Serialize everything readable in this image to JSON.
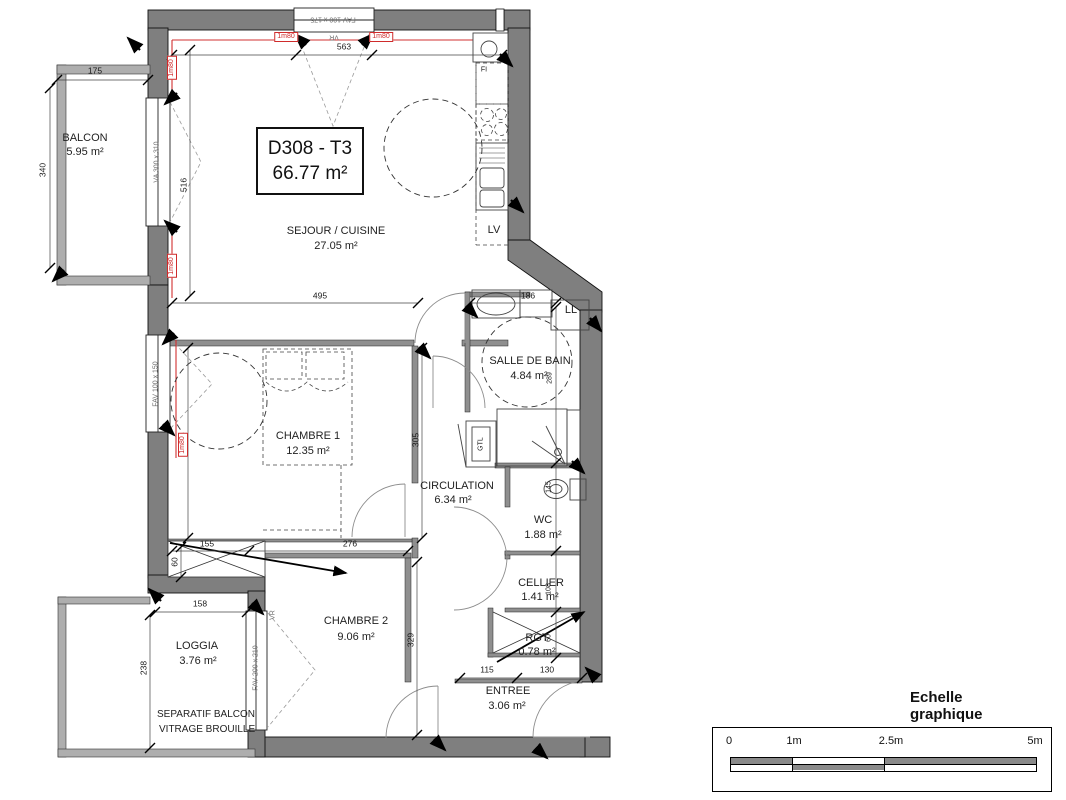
{
  "plan": {
    "unit": {
      "title": "D308 - T3",
      "area": "66.77 m²"
    },
    "rooms": [
      {
        "name": "BALCON",
        "area": "5.95 m²"
      },
      {
        "name": "SEJOUR / CUISINE",
        "area": "27.05 m²"
      },
      {
        "name": "CHAMBRE 1",
        "area": "12.35 m²"
      },
      {
        "name": "SALLE DE BAIN",
        "area": "4.84 m²"
      },
      {
        "name": "CIRCULATION",
        "area": "6.34 m²"
      },
      {
        "name": "WC",
        "area": "1.88 m²"
      },
      {
        "name": "CELLIER",
        "area": "1.41 m²"
      },
      {
        "name": "RGT",
        "area": "0.78 m²"
      },
      {
        "name": "CHAMBRE 2",
        "area": "9.06 m²"
      },
      {
        "name": "LOGGIA",
        "area": "3.76 m²"
      },
      {
        "name": "ENTREE",
        "area": "3.06 m²"
      }
    ],
    "appliances": {
      "dishwasher": "LV",
      "washer": "LL",
      "duct": "GTL",
      "fridge": "FI"
    },
    "windows": {
      "top": "FAV 100 x 175",
      "top_shutter": "VR",
      "bay": "VA 300 x 310",
      "chambre1": "FAV 100 x 150",
      "loggia": "FAV 200 x 210",
      "loggia_shutter": "VR"
    },
    "glazing_marker": "1m80",
    "note": {
      "line1": "SEPARATIF BALCON",
      "line2": "VITRAGE BROUILLE"
    },
    "dims": {
      "balcony_width": "175",
      "balcony_depth": "340",
      "sejour_width": "563",
      "bay_length": "516",
      "chambre1_width": "495",
      "bath_width": "186",
      "bath_depth": "289",
      "chambre1_depth": "310",
      "chambre1_depth_right": "305",
      "placard_width": "155",
      "placard_depth": "60",
      "chambre1_bottom": "276",
      "loggia_width": "158",
      "loggia_depth": "238",
      "chambre2_depth": "329",
      "entree_left": "115",
      "entree_right": "130",
      "wc_depth": "145",
      "cellier_depth": "108",
      "rgt_depth": "60"
    }
  },
  "scale": {
    "title": "Echelle graphique",
    "t0": "0",
    "t1": "1m",
    "t2": "2.5m",
    "t3": "5m"
  }
}
